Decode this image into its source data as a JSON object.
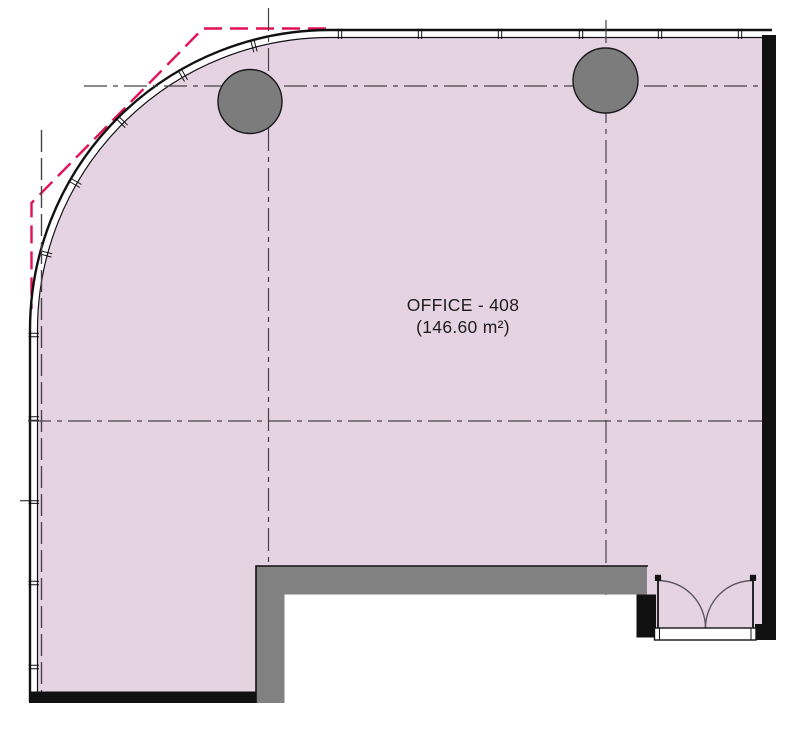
{
  "drawing": {
    "room_label": {
      "name": "OFFICE - 408",
      "area": "(146.60 m²)"
    }
  },
  "icons": {
    "column_icon": "filled-circle",
    "door_icon": "double-door-swing",
    "demolition_icon": "red-dashed-line",
    "grid_icon": "dash-dot-centerline",
    "curtain_wall_icon": "double-line-with-mullions"
  },
  "colors": {
    "canvas": "#ffffff",
    "room_fill": "#e5d3e4",
    "wall_line": "#111111",
    "wall_gray": "#818181",
    "column_fill": "#7c7c7c",
    "column_outline": "#1a1a1a",
    "grid_line": "#46414b",
    "demolition_red": "#e11253",
    "door_swing": "#5d5764",
    "door_frame": "#141414",
    "label_text": "#1d1d1d"
  }
}
